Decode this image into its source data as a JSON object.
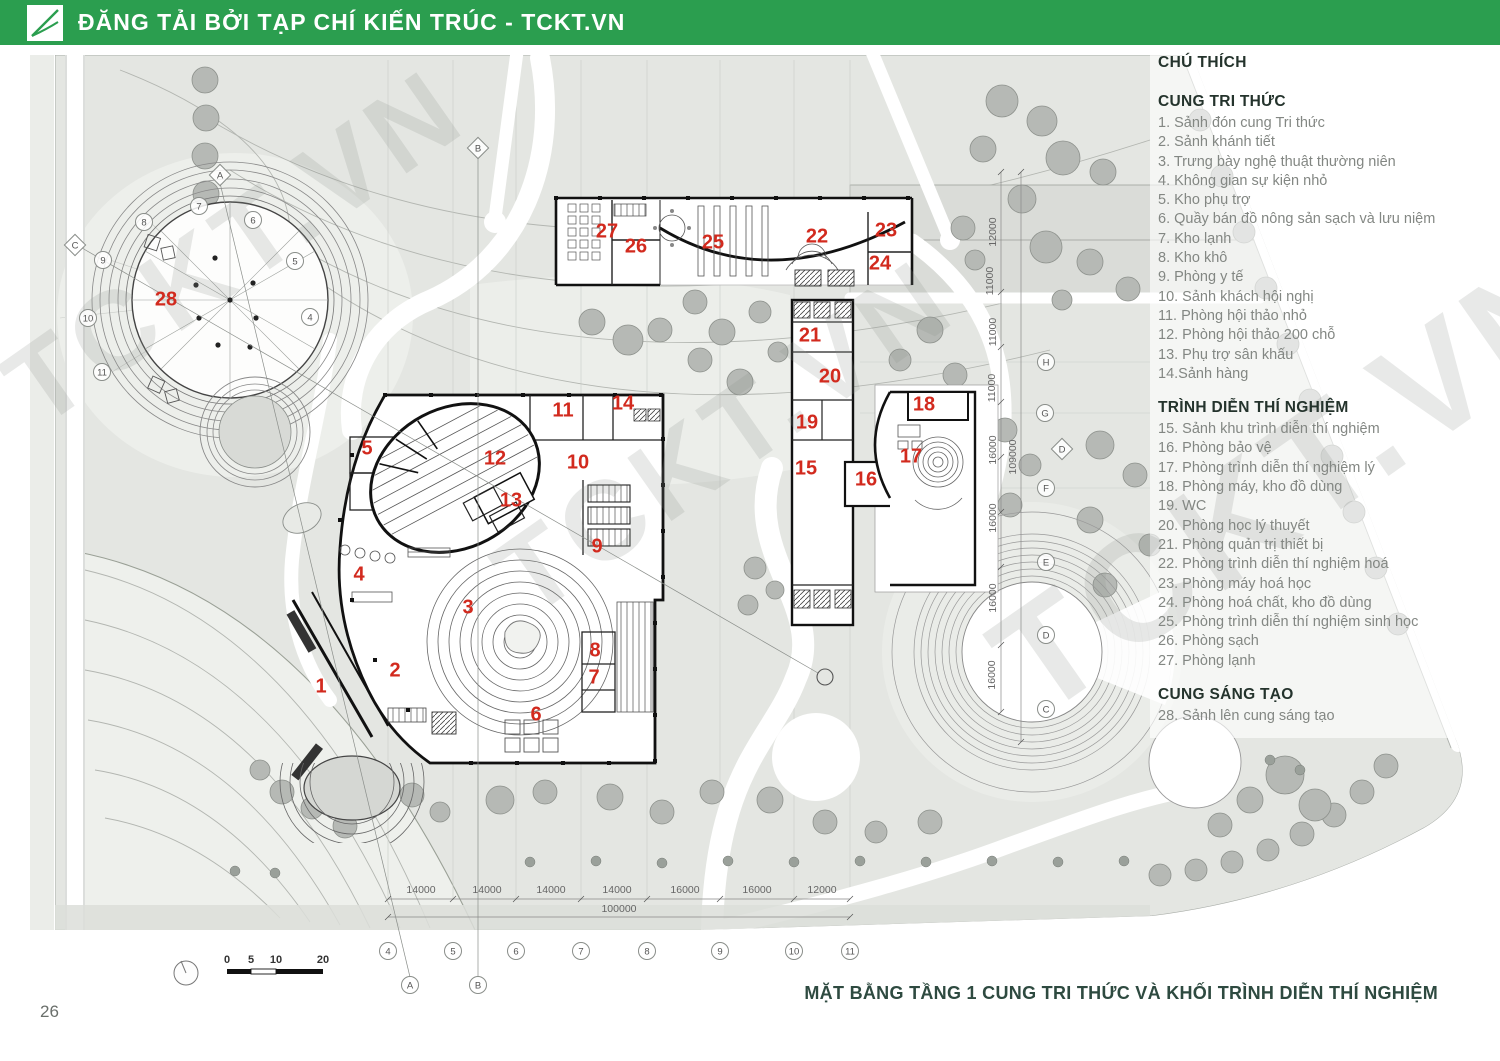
{
  "header": {
    "publisher": "ĐĂNG TẢI BỞI TẠP CHÍ KIẾN TRÚC - TCKT.VN",
    "logo": "tckt-logo"
  },
  "watermark": "TCKT.VN",
  "colors": {
    "header_green": "#2b9e4f",
    "caption_green": "#2e4a40",
    "room_red": "#d22a1e",
    "ground_gray": "#e4e6e2",
    "tree_gray": "#b6b9b5"
  },
  "legend": {
    "title": "CHÚ THÍCH",
    "sections": [
      {
        "heading": "CUNG TRI THỨC",
        "items": [
          "1. Sảnh đón cung Tri thức",
          "2. Sảnh khánh tiết",
          "3. Trưng bày nghệ thuật thường niên",
          "4. Không gian sự kiện nhỏ",
          "5. Kho phụ trợ",
          "6. Quầy  bán đồ nông sản sạch và lưu niệm",
          "7. Kho lạnh",
          "8. Kho khô",
          "9. Phòng y tế",
          "10. Sảnh khách hội nghị",
          "11. Phòng hội thảo nhỏ",
          "12. Phòng hội thảo 200 chỗ",
          "13. Phụ trợ sân khấu",
          "14.Sảnh hàng"
        ]
      },
      {
        "heading": "TRÌNH DIỄN THÍ NGHIỆM",
        "items": [
          "15. Sảnh khu trình diễn thí nghiệm",
          "16. Phòng bảo vệ",
          "17. Phòng trình diễn thí nghiệm lý",
          "18. Phòng máy, kho đồ dùng",
          "19. WC",
          "20. Phòng học lý thuyết",
          "21. Phòng quản trị thiết bị",
          "22. Phòng trình diễn thí nghiệm hoá",
          "23. Phòng máy hoá học",
          "24. Phòng hoá chất, kho đồ dùng",
          "25. Phòng trình diễn thí nghiệm sinh học",
          "26. Phòng sạch",
          "27. Phòng lạnh"
        ]
      },
      {
        "heading": "CUNG SÁNG TẠO",
        "items": [
          "28. Sảnh lên cung sáng tạo"
        ]
      }
    ]
  },
  "plan": {
    "rooms": [
      {
        "n": "1",
        "x": 321,
        "y": 687
      },
      {
        "n": "2",
        "x": 395,
        "y": 671
      },
      {
        "n": "3",
        "x": 468,
        "y": 608
      },
      {
        "n": "4",
        "x": 359,
        "y": 575
      },
      {
        "n": "5",
        "x": 367,
        "y": 449
      },
      {
        "n": "6",
        "x": 536,
        "y": 715
      },
      {
        "n": "7",
        "x": 594,
        "y": 678
      },
      {
        "n": "8",
        "x": 595,
        "y": 651
      },
      {
        "n": "9",
        "x": 597,
        "y": 547
      },
      {
        "n": "10",
        "x": 578,
        "y": 463
      },
      {
        "n": "11",
        "x": 563,
        "y": 411
      },
      {
        "n": "12",
        "x": 495,
        "y": 459
      },
      {
        "n": "13",
        "x": 511,
        "y": 501
      },
      {
        "n": "14",
        "x": 623,
        "y": 404
      },
      {
        "n": "15",
        "x": 806,
        "y": 469
      },
      {
        "n": "16",
        "x": 866,
        "y": 480
      },
      {
        "n": "17",
        "x": 911,
        "y": 457
      },
      {
        "n": "18",
        "x": 924,
        "y": 405
      },
      {
        "n": "19",
        "x": 807,
        "y": 423
      },
      {
        "n": "20",
        "x": 830,
        "y": 377
      },
      {
        "n": "21",
        "x": 810,
        "y": 336
      },
      {
        "n": "22",
        "x": 817,
        "y": 237
      },
      {
        "n": "23",
        "x": 886,
        "y": 231
      },
      {
        "n": "24",
        "x": 880,
        "y": 264
      },
      {
        "n": "25",
        "x": 713,
        "y": 243
      },
      {
        "n": "26",
        "x": 636,
        "y": 247
      },
      {
        "n": "27",
        "x": 607,
        "y": 232
      },
      {
        "n": "28",
        "x": 166,
        "y": 300
      }
    ],
    "grid_bubbles": [
      {
        "label": "A",
        "x": 220,
        "y": 175,
        "shape": "d"
      },
      {
        "label": "B",
        "x": 478,
        "y": 148,
        "shape": "d"
      },
      {
        "label": "C",
        "x": 75,
        "y": 245,
        "shape": "d"
      },
      {
        "label": "D",
        "x": 1062,
        "y": 449,
        "shape": "d"
      },
      {
        "label": "7",
        "x": 199,
        "y": 206,
        "shape": "c"
      },
      {
        "label": "8",
        "x": 144,
        "y": 222,
        "shape": "c"
      },
      {
        "label": "6",
        "x": 253,
        "y": 220,
        "shape": "c"
      },
      {
        "label": "9",
        "x": 103,
        "y": 260,
        "shape": "c"
      },
      {
        "label": "5",
        "x": 295,
        "y": 261,
        "shape": "c"
      },
      {
        "label": "10",
        "x": 88,
        "y": 318,
        "shape": "c"
      },
      {
        "label": "4",
        "x": 310,
        "y": 317,
        "shape": "c"
      },
      {
        "label": "11",
        "x": 102,
        "y": 372,
        "shape": "c"
      },
      {
        "label": "H",
        "x": 1046,
        "y": 362,
        "shape": "c"
      },
      {
        "label": "G",
        "x": 1045,
        "y": 413,
        "shape": "c"
      },
      {
        "label": "F",
        "x": 1046,
        "y": 488,
        "shape": "c"
      },
      {
        "label": "E",
        "x": 1046,
        "y": 562,
        "shape": "c"
      },
      {
        "label": "D",
        "x": 1046,
        "y": 635,
        "shape": "c"
      },
      {
        "label": "C",
        "x": 1046,
        "y": 709,
        "shape": "c"
      },
      {
        "label": "4",
        "x": 388,
        "y": 951,
        "shape": "c"
      },
      {
        "label": "5",
        "x": 453,
        "y": 951,
        "shape": "c"
      },
      {
        "label": "6",
        "x": 516,
        "y": 951,
        "shape": "c"
      },
      {
        "label": "7",
        "x": 581,
        "y": 951,
        "shape": "c"
      },
      {
        "label": "8",
        "x": 647,
        "y": 951,
        "shape": "c"
      },
      {
        "label": "9",
        "x": 720,
        "y": 951,
        "shape": "c"
      },
      {
        "label": "10",
        "x": 794,
        "y": 951,
        "shape": "c"
      },
      {
        "label": "11",
        "x": 850,
        "y": 951,
        "shape": "c"
      },
      {
        "label": "A",
        "x": 410,
        "y": 985,
        "shape": "c"
      },
      {
        "label": "B",
        "x": 478,
        "y": 985,
        "shape": "c"
      }
    ],
    "dims_bottom": [
      {
        "t": "14000",
        "x": 421
      },
      {
        "t": "14000",
        "x": 487
      },
      {
        "t": "14000",
        "x": 551
      },
      {
        "t": "14000",
        "x": 617
      },
      {
        "t": "16000",
        "x": 685
      },
      {
        "t": "16000",
        "x": 757
      },
      {
        "t": "12000",
        "x": 822
      }
    ],
    "dims_bottom_total": "100000",
    "dims_right": [
      {
        "t": "12000",
        "x": 996,
        "y": 232
      },
      {
        "t": "11000",
        "x": 993,
        "y": 281
      },
      {
        "t": "11000",
        "x": 996,
        "y": 332
      },
      {
        "t": "11000",
        "x": 995,
        "y": 388
      },
      {
        "t": "16000",
        "x": 996,
        "y": 450
      },
      {
        "t": "16000",
        "x": 996,
        "y": 518
      },
      {
        "t": "16000",
        "x": 996,
        "y": 598
      },
      {
        "t": "16000",
        "x": 995,
        "y": 675
      },
      {
        "t": "109000",
        "x": 1016,
        "y": 457
      }
    ],
    "scalebar": [
      {
        "t": "0",
        "x": 227
      },
      {
        "t": "5",
        "x": 251
      },
      {
        "t": "10",
        "x": 276
      },
      {
        "t": "20",
        "x": 323
      }
    ]
  },
  "caption": "MẶT BẰNG TẦNG 1 CUNG TRI THỨC VÀ KHỐI TRÌNH DIỄN THÍ NGHIỆM",
  "page_number": "26"
}
